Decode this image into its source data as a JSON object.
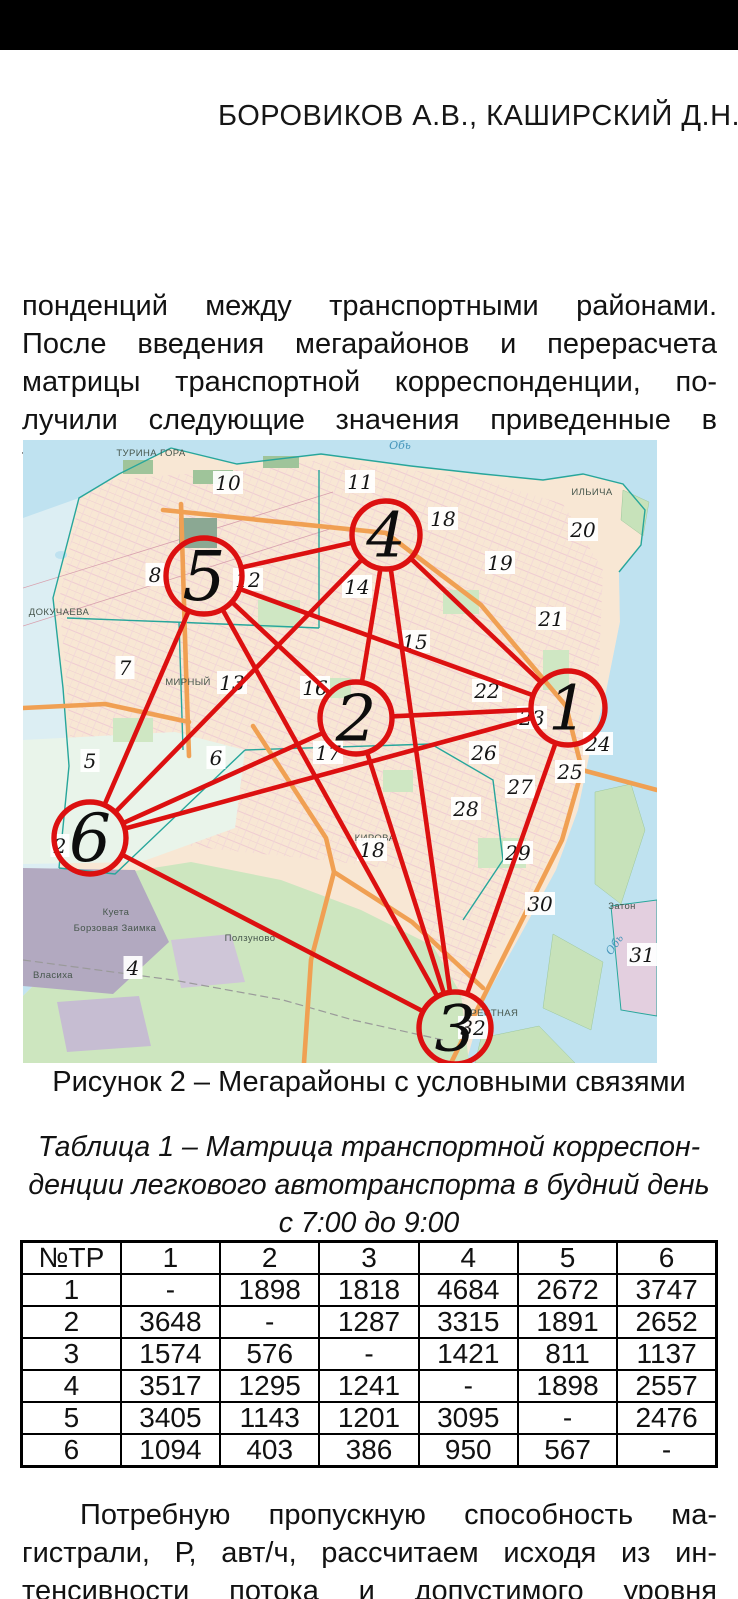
{
  "header": {
    "running_head": "БОРОВИКОВ А.В., КАШИРСКИЙ Д.Н."
  },
  "paragraph_top": {
    "lines": [
      "понденций между транспортными районами.",
      "После введения мегарайонов и перерасчета",
      "матрицы транспортной корреспонденции, по-",
      "лучили следующие значения приведенные в",
      "таблице 1."
    ]
  },
  "figure": {
    "caption": "Рисунок 2 – Мегарайоны с условными связями",
    "map": {
      "colors": {
        "overlay_red": "#dc1010",
        "water": "#bfe2f0",
        "pale_water": "#dceef3",
        "land": "#f8e7d4",
        "forest_green": "#cde6bf",
        "island_green": "#c7e2ba",
        "industrial_grey": "#b2a9c0",
        "road_orange": "#f0a053",
        "boundary_teal": "#27a69b"
      },
      "megaraions": [
        {
          "id": "1",
          "x": 545,
          "y": 268,
          "r": 37,
          "fs": 62
        },
        {
          "id": "2",
          "x": 333,
          "y": 278,
          "r": 36,
          "fs": 64
        },
        {
          "id": "3",
          "x": 432,
          "y": 588,
          "r": 36,
          "fs": 64
        },
        {
          "id": "4",
          "x": 363,
          "y": 95,
          "r": 34,
          "fs": 62
        },
        {
          "id": "5",
          "x": 181,
          "y": 136,
          "r": 38,
          "fs": 68
        },
        {
          "id": "6",
          "x": 67,
          "y": 398,
          "r": 36,
          "fs": 66
        }
      ],
      "links": [
        [
          "1",
          "2"
        ],
        [
          "1",
          "3"
        ],
        [
          "1",
          "4"
        ],
        [
          "1",
          "5"
        ],
        [
          "1",
          "6"
        ],
        [
          "2",
          "3"
        ],
        [
          "2",
          "4"
        ],
        [
          "2",
          "5"
        ],
        [
          "2",
          "6"
        ],
        [
          "3",
          "4"
        ],
        [
          "3",
          "5"
        ],
        [
          "3",
          "6"
        ],
        [
          "4",
          "5"
        ],
        [
          "4",
          "6"
        ],
        [
          "5",
          "6"
        ]
      ],
      "district_labels": [
        {
          "t": "10",
          "x": 205,
          "y": 43
        },
        {
          "t": "11",
          "x": 337,
          "y": 42
        },
        {
          "t": "18",
          "x": 420,
          "y": 79
        },
        {
          "t": "20",
          "x": 560,
          "y": 90
        },
        {
          "t": "19",
          "x": 477,
          "y": 123
        },
        {
          "t": "8",
          "x": 132,
          "y": 135
        },
        {
          "t": "12",
          "x": 225,
          "y": 140
        },
        {
          "t": "14",
          "x": 334,
          "y": 147
        },
        {
          "t": "21",
          "x": 528,
          "y": 179
        },
        {
          "t": "15",
          "x": 392,
          "y": 202
        },
        {
          "t": "7",
          "x": 102,
          "y": 228
        },
        {
          "t": "13",
          "x": 209,
          "y": 243
        },
        {
          "t": "16",
          "x": 292,
          "y": 248
        },
        {
          "t": "22",
          "x": 464,
          "y": 251
        },
        {
          "t": "23",
          "x": 509,
          "y": 278
        },
        {
          "t": "24",
          "x": 575,
          "y": 304
        },
        {
          "t": "17",
          "x": 305,
          "y": 313
        },
        {
          "t": "26",
          "x": 461,
          "y": 313
        },
        {
          "t": "25",
          "x": 547,
          "y": 332
        },
        {
          "t": "5",
          "x": 67,
          "y": 321
        },
        {
          "t": "6",
          "x": 193,
          "y": 318
        },
        {
          "t": "27",
          "x": 497,
          "y": 347
        },
        {
          "t": "28",
          "x": 443,
          "y": 369
        },
        {
          "t": "2",
          "x": 37,
          "y": 406
        },
        {
          "t": "18",
          "x": 349,
          "y": 410
        },
        {
          "t": "29",
          "x": 495,
          "y": 413
        },
        {
          "t": "30",
          "x": 517,
          "y": 464
        },
        {
          "t": "31",
          "x": 619,
          "y": 515
        },
        {
          "t": "4",
          "x": 110,
          "y": 528
        },
        {
          "t": "32",
          "x": 450,
          "y": 588
        }
      ],
      "place_labels": [
        {
          "t": "ТУРИНА ГОРА",
          "x": 128,
          "y": 13
        },
        {
          "t": "Обь",
          "x": 377,
          "y": 6,
          "c": "water-name"
        },
        {
          "t": "ИЛЬИЧА",
          "x": 569,
          "y": 52
        },
        {
          "t": "ДОКУЧАЕВА",
          "x": 36,
          "y": 172
        },
        {
          "t": "МИРНЫЙ",
          "x": 165,
          "y": 242
        },
        {
          "t": "КИРОВА",
          "x": 352,
          "y": 398
        },
        {
          "t": "Куета",
          "x": 93,
          "y": 472
        },
        {
          "t": "Затон",
          "x": 599,
          "y": 466
        },
        {
          "t": "Борзовая Заимка",
          "x": 92,
          "y": 488
        },
        {
          "t": "Ползуново",
          "x": 227,
          "y": 498
        },
        {
          "t": "Власиха",
          "x": 30,
          "y": 535
        },
        {
          "t": "ЕРЕСТНАЯ",
          "x": 468,
          "y": 573
        },
        {
          "t": "Обь",
          "x": 592,
          "y": 505,
          "rot": -55,
          "c": "water-name"
        }
      ]
    }
  },
  "table": {
    "title_lines": [
      "Таблица 1 – Матрица транспортной корреспон-",
      "денции легкового автотранспорта в будний день",
      "с 7:00 до 9:00"
    ],
    "col_headers": [
      "№ТР",
      "1",
      "2",
      "3",
      "4",
      "5",
      "6"
    ],
    "rows": [
      [
        "1",
        "-",
        "1898",
        "1818",
        "4684",
        "2672",
        "3747"
      ],
      [
        "2",
        "3648",
        "-",
        "1287",
        "3315",
        "1891",
        "2652"
      ],
      [
        "3",
        "1574",
        "576",
        "-",
        "1421",
        "811",
        "1137"
      ],
      [
        "4",
        "3517",
        "1295",
        "1241",
        "-",
        "1898",
        "2557"
      ],
      [
        "5",
        "3405",
        "1143",
        "1201",
        "3095",
        "-",
        "2476"
      ],
      [
        "6",
        "1094",
        "403",
        "386",
        "950",
        "567",
        "-"
      ]
    ]
  },
  "paragraph_bottom": {
    "lines": [
      "Потребную пропускную способность ма-",
      "гистрали, Р, авт/ч, рассчитаем исходя из ин-",
      "тенсивности потока и допустимого уровня"
    ]
  }
}
